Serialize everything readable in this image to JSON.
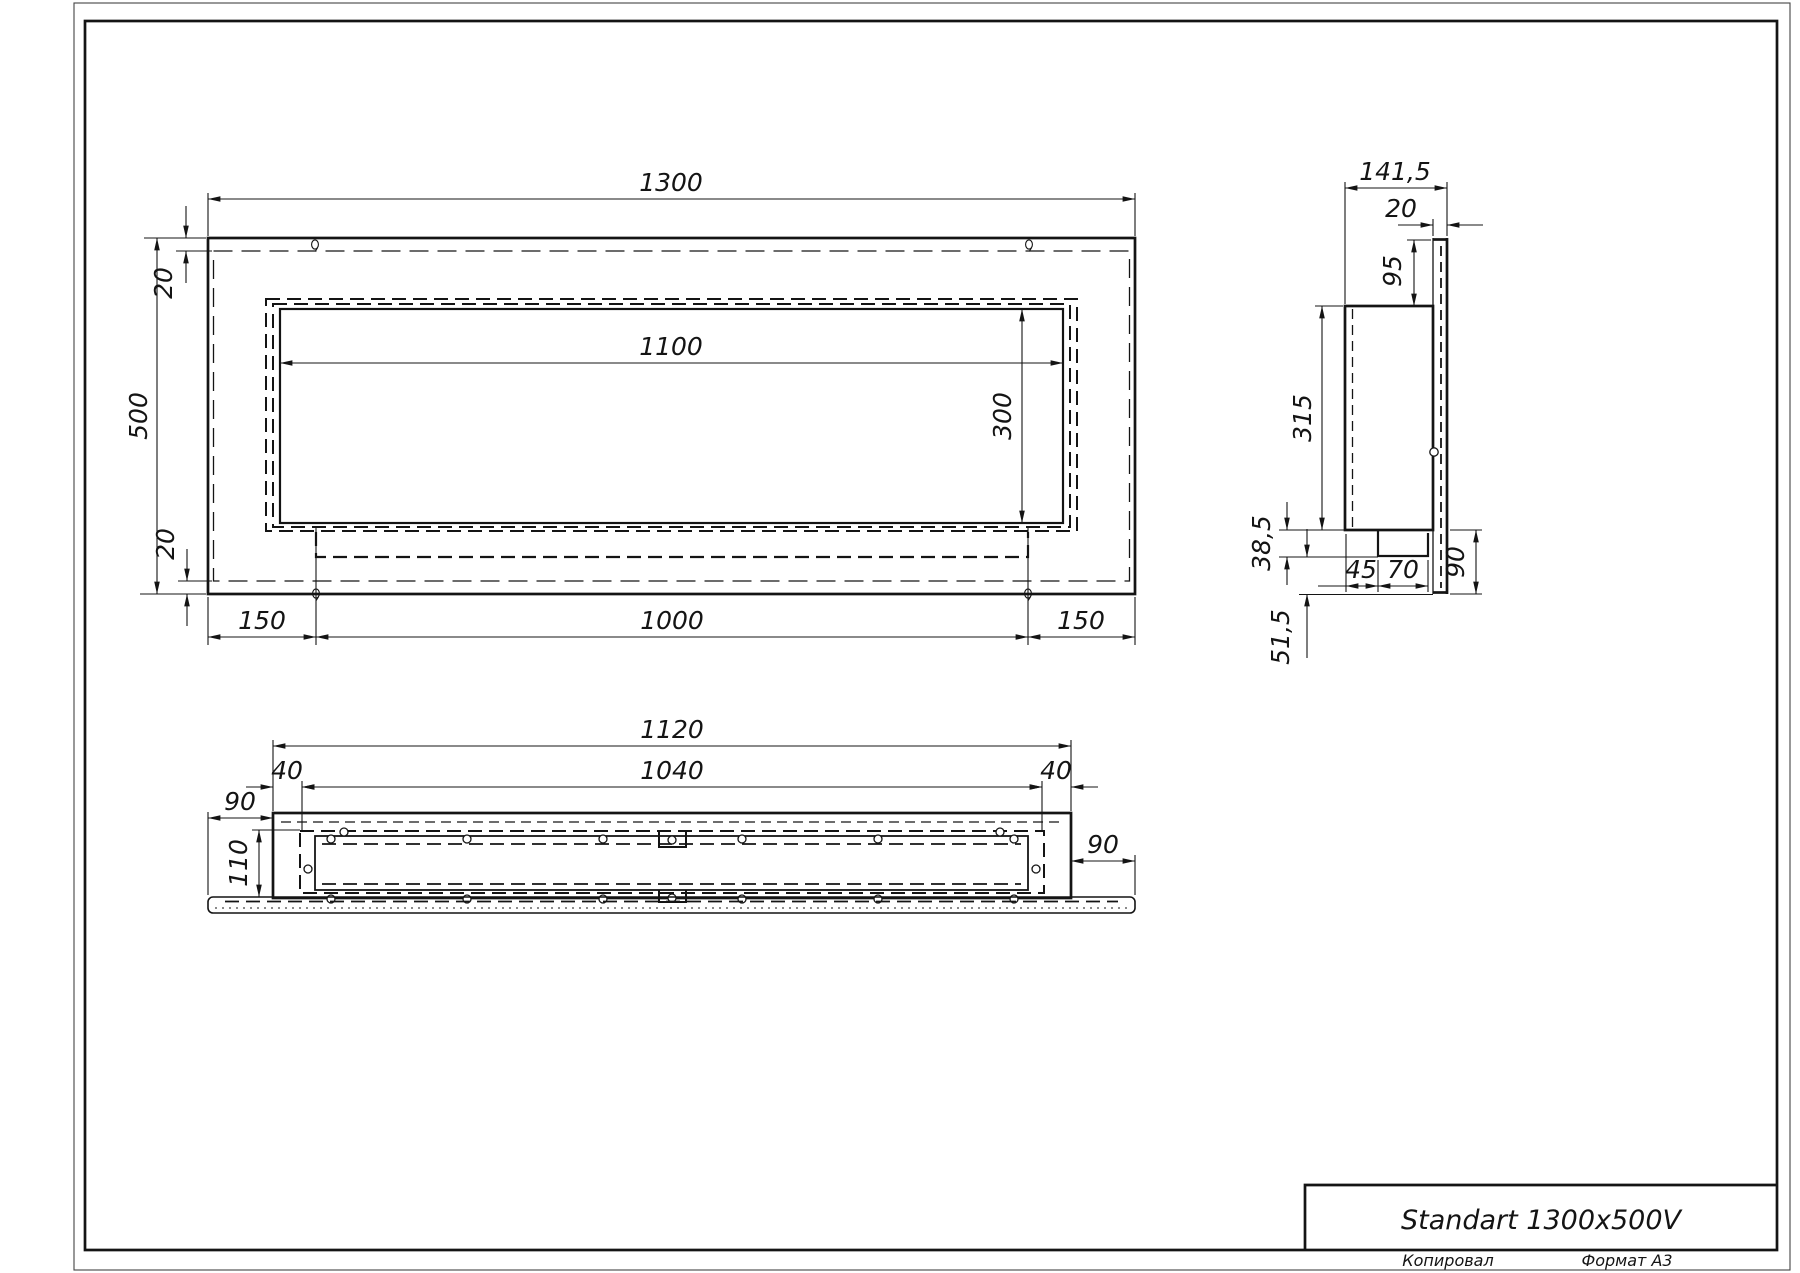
{
  "colors": {
    "ink": "#141414",
    "background": "#ffffff"
  },
  "title_block": {
    "title": "Standart 1300x500V",
    "copied_label": "Копировал",
    "format_label": "Формат А3"
  },
  "front_view": {
    "width": "1300",
    "height": "500",
    "top_inset": "20",
    "bottom_inset": "20",
    "opening_width": "1100",
    "opening_height": "300",
    "left_margin": "150",
    "mount_span": "1000",
    "right_margin": "150"
  },
  "side_view": {
    "depth": "141,5",
    "panel_thickness": "20",
    "panel_overhang": "95",
    "body_height": "315",
    "tray_depth": "38,5",
    "tray_offset": "45",
    "tray_width": "70",
    "lower_height": "90",
    "lower_overhang": "51,5"
  },
  "bottom_view": {
    "width": "1120",
    "opening_width": "1040",
    "left_inset": "40",
    "right_inset": "40",
    "left_overhang": "90",
    "right_overhang": "90",
    "depth": "110"
  }
}
